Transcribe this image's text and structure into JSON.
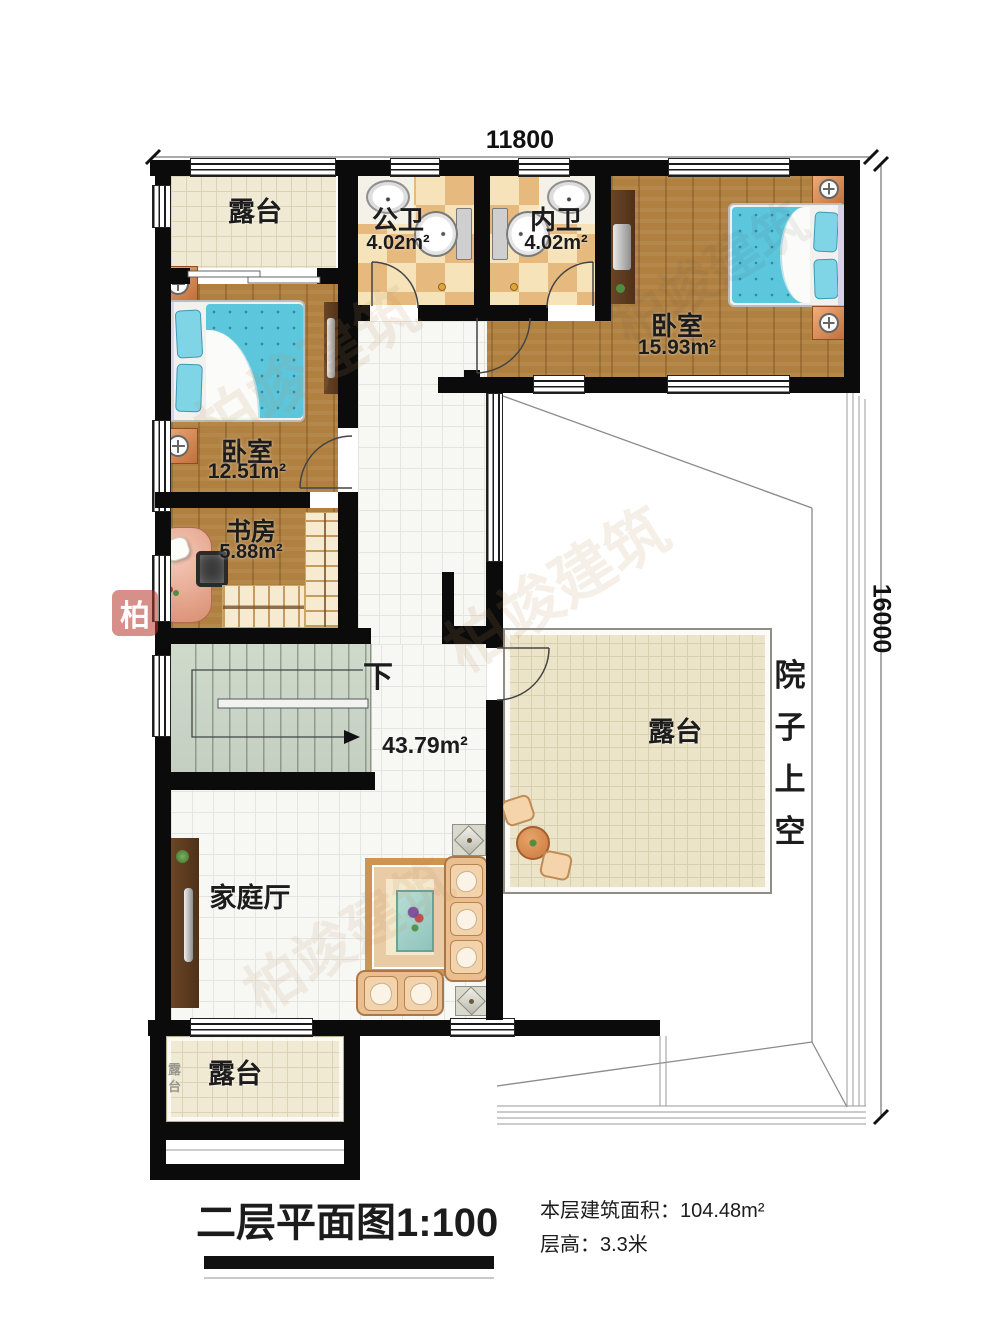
{
  "plan": {
    "dim_top": "11800",
    "dim_right": "16000",
    "stairs_label": "下",
    "hall_area": "43.79m²"
  },
  "rooms": {
    "terrace_top": {
      "label": "露台"
    },
    "bath_public": {
      "label": "公卫",
      "area": "4.02m²"
    },
    "bath_private": {
      "label": "内卫",
      "area": "4.02m²"
    },
    "bedroom_right": {
      "label": "卧室",
      "area": "15.93m²"
    },
    "bedroom_left": {
      "label": "卧室",
      "area": "12.51m²"
    },
    "study": {
      "label": "书房",
      "area": "5.88m²"
    },
    "family_hall": {
      "label": "家庭厅"
    },
    "terrace_middle": {
      "label": "露台"
    },
    "terrace_bottom": {
      "label": "露台"
    },
    "courtyard": {
      "label": "院子上空"
    }
  },
  "title_block": {
    "title": "二层平面图1:100",
    "area_note": "本层建筑面积：104.48m²",
    "height_note": "层高：3.3米"
  },
  "watermark": {
    "text": "柏竣建筑",
    "logo_char": "柏",
    "mini": "露台"
  }
}
